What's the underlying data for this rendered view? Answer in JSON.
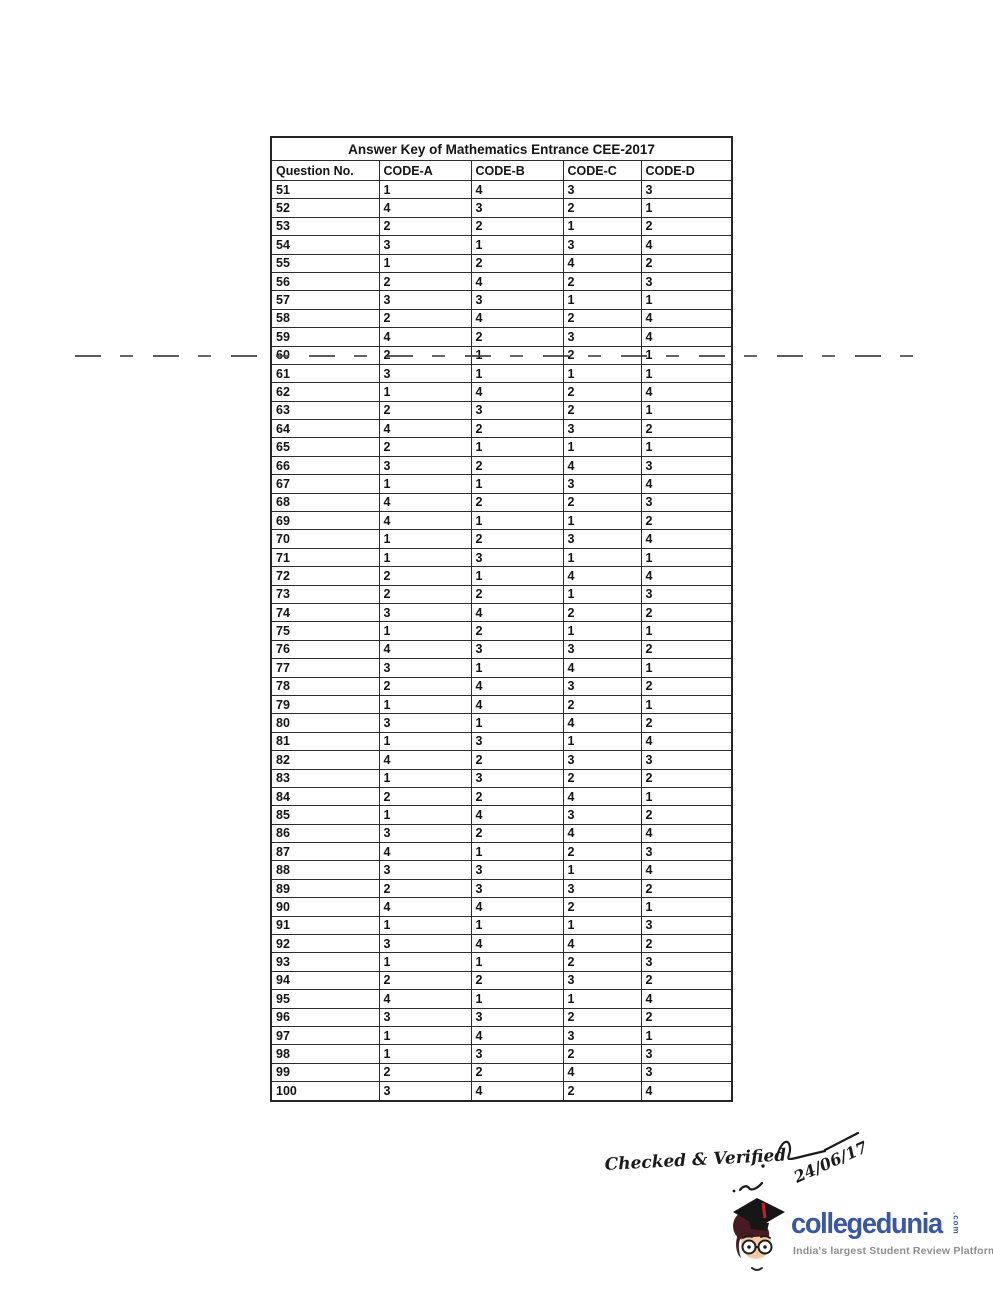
{
  "document": {
    "table": {
      "title": "Answer Key of Mathematics Entrance CEE-2017",
      "columns": [
        "Question No.",
        "CODE-A",
        "CODE-B",
        "CODE-C",
        "CODE-D"
      ],
      "rows": [
        [
          51,
          1,
          4,
          3,
          3
        ],
        [
          52,
          4,
          3,
          2,
          1
        ],
        [
          53,
          2,
          2,
          1,
          2
        ],
        [
          54,
          3,
          1,
          3,
          4
        ],
        [
          55,
          1,
          2,
          4,
          2
        ],
        [
          56,
          2,
          4,
          2,
          3
        ],
        [
          57,
          3,
          3,
          1,
          1
        ],
        [
          58,
          2,
          4,
          2,
          4
        ],
        [
          59,
          4,
          2,
          3,
          4
        ],
        [
          60,
          2,
          1,
          2,
          1
        ],
        [
          61,
          3,
          1,
          1,
          1
        ],
        [
          62,
          1,
          4,
          2,
          4
        ],
        [
          63,
          2,
          3,
          2,
          1
        ],
        [
          64,
          4,
          2,
          3,
          2
        ],
        [
          65,
          2,
          1,
          1,
          1
        ],
        [
          66,
          3,
          2,
          4,
          3
        ],
        [
          67,
          1,
          1,
          3,
          4
        ],
        [
          68,
          4,
          2,
          2,
          3
        ],
        [
          69,
          4,
          1,
          1,
          2
        ],
        [
          70,
          1,
          2,
          3,
          4
        ],
        [
          71,
          1,
          3,
          1,
          1
        ],
        [
          72,
          2,
          1,
          4,
          4
        ],
        [
          73,
          2,
          2,
          1,
          3
        ],
        [
          74,
          3,
          4,
          2,
          2
        ],
        [
          75,
          1,
          2,
          1,
          1
        ],
        [
          76,
          4,
          3,
          3,
          2
        ],
        [
          77,
          3,
          1,
          4,
          1
        ],
        [
          78,
          2,
          4,
          3,
          2
        ],
        [
          79,
          1,
          4,
          2,
          1
        ],
        [
          80,
          3,
          1,
          4,
          2
        ],
        [
          81,
          1,
          3,
          1,
          4
        ],
        [
          82,
          4,
          2,
          3,
          3
        ],
        [
          83,
          1,
          3,
          2,
          2
        ],
        [
          84,
          2,
          2,
          4,
          1
        ],
        [
          85,
          1,
          4,
          3,
          2
        ],
        [
          86,
          3,
          2,
          4,
          4
        ],
        [
          87,
          4,
          1,
          2,
          3
        ],
        [
          88,
          3,
          3,
          1,
          4
        ],
        [
          89,
          2,
          3,
          3,
          2
        ],
        [
          90,
          4,
          4,
          2,
          1
        ],
        [
          91,
          1,
          1,
          1,
          3
        ],
        [
          92,
          3,
          4,
          4,
          2
        ],
        [
          93,
          1,
          1,
          2,
          3
        ],
        [
          94,
          2,
          2,
          3,
          2
        ],
        [
          95,
          4,
          1,
          1,
          4
        ],
        [
          96,
          3,
          3,
          2,
          2
        ],
        [
          97,
          1,
          4,
          3,
          1
        ],
        [
          98,
          1,
          3,
          2,
          3
        ],
        [
          99,
          2,
          2,
          4,
          3
        ],
        [
          100,
          3,
          4,
          2,
          4
        ]
      ]
    },
    "handwriting": {
      "checked_text": "Checked & Verified",
      "date_text": "24/06/17"
    },
    "logo": {
      "brand": "collegedunia",
      "suffix": ".com",
      "tagline": "India's largest Student Review Platform",
      "brand_color": "#3a57a3",
      "tagline_color": "#8d8d8d",
      "tassel_color": "#c8201e"
    }
  }
}
